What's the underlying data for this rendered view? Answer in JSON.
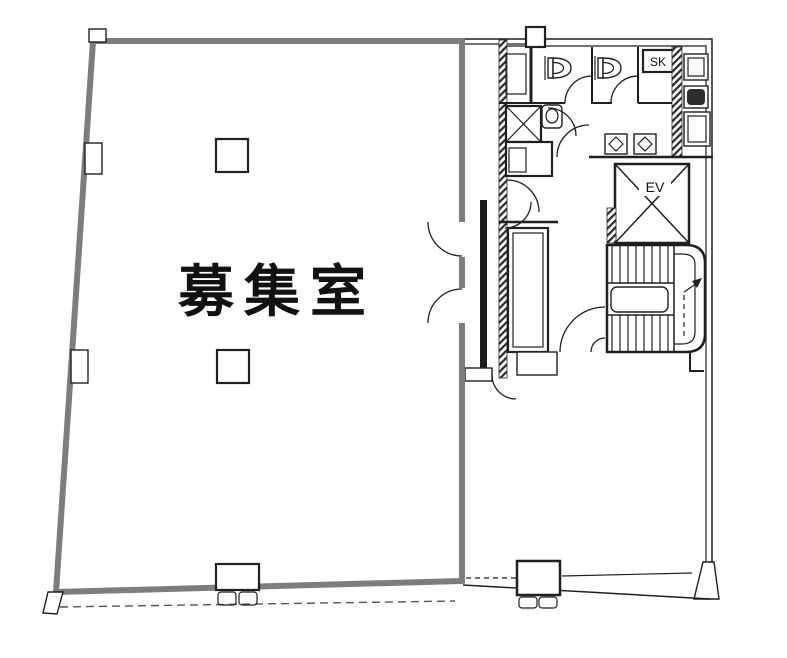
{
  "meta": {
    "type": "architectural-floor-plan",
    "width_px": 787,
    "height_px": 658
  },
  "labels": {
    "main_room": "募集室",
    "elevator": "EV",
    "sink_closet": "SK"
  },
  "colors": {
    "bg": "#ffffff",
    "wall_gray": "#7d7d7d",
    "line": "#1f1f1f",
    "ground_dash": "#555555"
  }
}
